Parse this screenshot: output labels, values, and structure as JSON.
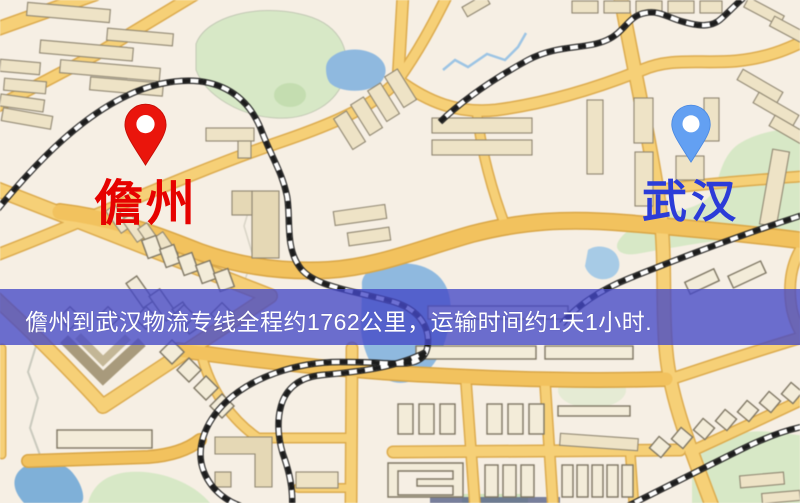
{
  "banner": {
    "text": "儋州到武汉物流专线全程约1762公里，运输时间约1天1小时."
  },
  "route": {
    "origin": "儋州",
    "destination": "武汉",
    "distance": "约1762公里",
    "duration": "约1天1小时"
  },
  "markers": {
    "origin": {
      "label": "儋州",
      "icon": "location-pin-icon"
    },
    "destination": {
      "label": "武汉",
      "icon": "location-pin-icon"
    }
  },
  "palette": {
    "banner-bg": "rgba(68,72,198,0.78)",
    "banner-text": "#ffffff",
    "origin-label": "#e60200",
    "dest-label": "#2b3cd8",
    "origin-pin": "#ea150c",
    "dest-pin": "#63a0f2",
    "road-fill": "#f6d077",
    "building-fill": "#eee3c6",
    "green-area": "#d7e8c6",
    "water": "#8fb9df",
    "map-background": "#f6efe4"
  }
}
